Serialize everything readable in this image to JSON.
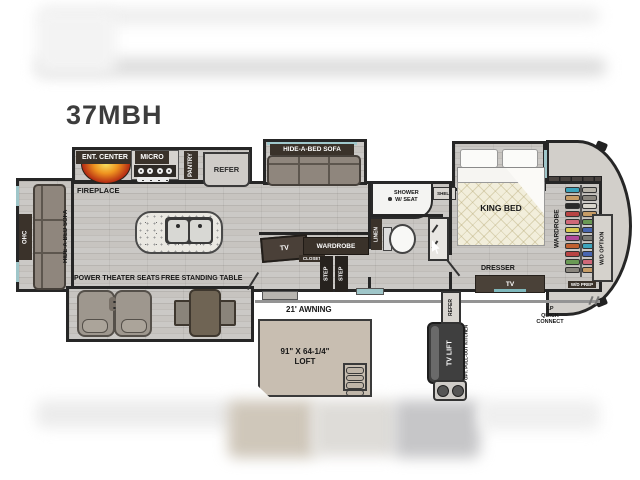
{
  "title": "37MBH",
  "fp": {
    "kitchen": {
      "ent_center": "ENT. CENTER",
      "fireplace": "FIREPLACE",
      "micro": "MICRO",
      "pantry": "PANTRY",
      "refer": "REFER"
    },
    "living": {
      "sofa_top": "HIDE-A-BED SOFA",
      "sofa_left": "HIDE-A-BED SOFA",
      "ohc": "OHC",
      "theater": "POWER THEATER SEATS",
      "table": "FREE STANDING TABLE",
      "tv": "TV"
    },
    "mid": {
      "wardrobe": "WARDROBE",
      "closet": "CLOSET",
      "step": "STEP"
    },
    "bath": {
      "shower_l1": "SHOWER",
      "shower_l2": "W/ SEAT",
      "shelf": "SHELF",
      "linen": "LINEN"
    },
    "bedroom": {
      "king_bed": "KING BED",
      "dresser": "DRESSER",
      "tv": "TV",
      "wardrobe": "WARDROBE",
      "wd_option": "W/D OPTION",
      "wd_prep": "W/D PREP"
    },
    "exterior": {
      "awning": "21' AWNING",
      "loft_l1": "91\" X 64-1/4\"",
      "loft_l2": "LOFT",
      "refer": "REFER",
      "tv_lift": "TV LIFT",
      "opt_kitchen": "OPT. PULL-OUT KITCHEN",
      "lp_l1": "LP",
      "lp_l2": "QUICK",
      "lp_l3": "CONNECT"
    }
  },
  "colors": {
    "wall": "#262626",
    "floor": "#c5c2be",
    "label_bg": "#3a322a",
    "teal_accent": "#9fc6c9",
    "fireplace_core": "#f2c43c",
    "fireplace_edge": "#8c2210",
    "loft_fill": "#c8beb1",
    "clothes": [
      "#3da4bc",
      "#b8b4aa",
      "#c69c66",
      "#8a867e",
      "#2a2a2a",
      "#d8d5cc",
      "#b84444",
      "#c69c66",
      "#d06878",
      "#6a9a55",
      "#d8c850",
      "#4866b0",
      "#b0489a",
      "#7a7a74",
      "#c06030",
      "#3da4bc",
      "#b84444",
      "#4866b0",
      "#6a9a55",
      "#d06878",
      "#8a867e",
      "#c69c66"
    ]
  }
}
